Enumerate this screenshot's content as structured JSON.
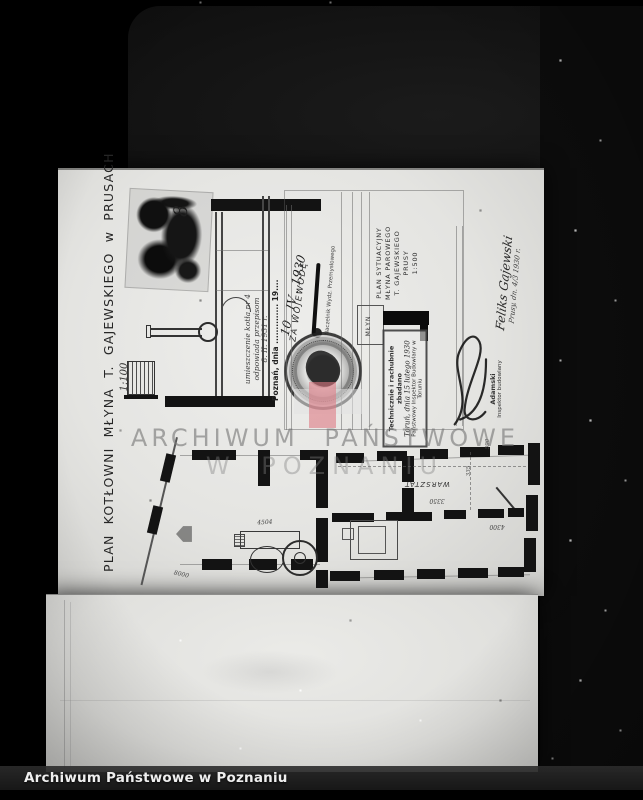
{
  "footer": {
    "label": "Archiwum Państwowe w Poznaniu"
  },
  "watermark": {
    "line1": "ARCHIWUM PAŃSTWOWE",
    "line2": "W POZNANIU",
    "logo_red": "#e9959f",
    "logo_grey": "#e1e1e1"
  },
  "drawing": {
    "side_title": "PLAN KOTŁOWNI  MŁYNA  T. GAJEWSKIEGO  w  PRUSACH",
    "side_scale": "1:100",
    "corner_number": "8",
    "office": {
      "date_line": "Poznań, dnia .............. 19....",
      "big_date": "10 . IV . 1930",
      "za_wojewode": "ZA WOJEWODĘ",
      "naczelnik": "Naczelnik Wydz. Przemysłowego",
      "note_line1": "umieszczenie kotła nr 4",
      "note_line2": "odpowiada przepisom",
      "note_line3": "8. II. 1931 r."
    },
    "site_plan": {
      "title1": "PLAN SYTUACYJNY",
      "title2": "MŁYNA PAROWEGO",
      "title3": "T. GAJEWSKIEGO",
      "title4": "PRUSY",
      "title5": "1:500",
      "building_label": "MŁYN"
    },
    "stamp": {
      "line1": "Technicznie i rachubnie zbadano",
      "line2": "Toruń, dnia 15 lutego 1930",
      "line3": "Państwowy Inspektor Budowlany w Toruniu"
    },
    "inspector_name": "Adamski",
    "inspector_title": "Inspektor budowlany",
    "signature_name": "Feliks Gajewski",
    "signature_place": "Prusy, dn. 4/3 1930 r.",
    "plan_labels": {
      "room": "WARSZTAT",
      "dim_8000": "8000",
      "dim_4504": "4504",
      "dim_3350": "3350",
      "dim_4300": "4300",
      "dim_335": "335",
      "dim_590": "590"
    }
  }
}
